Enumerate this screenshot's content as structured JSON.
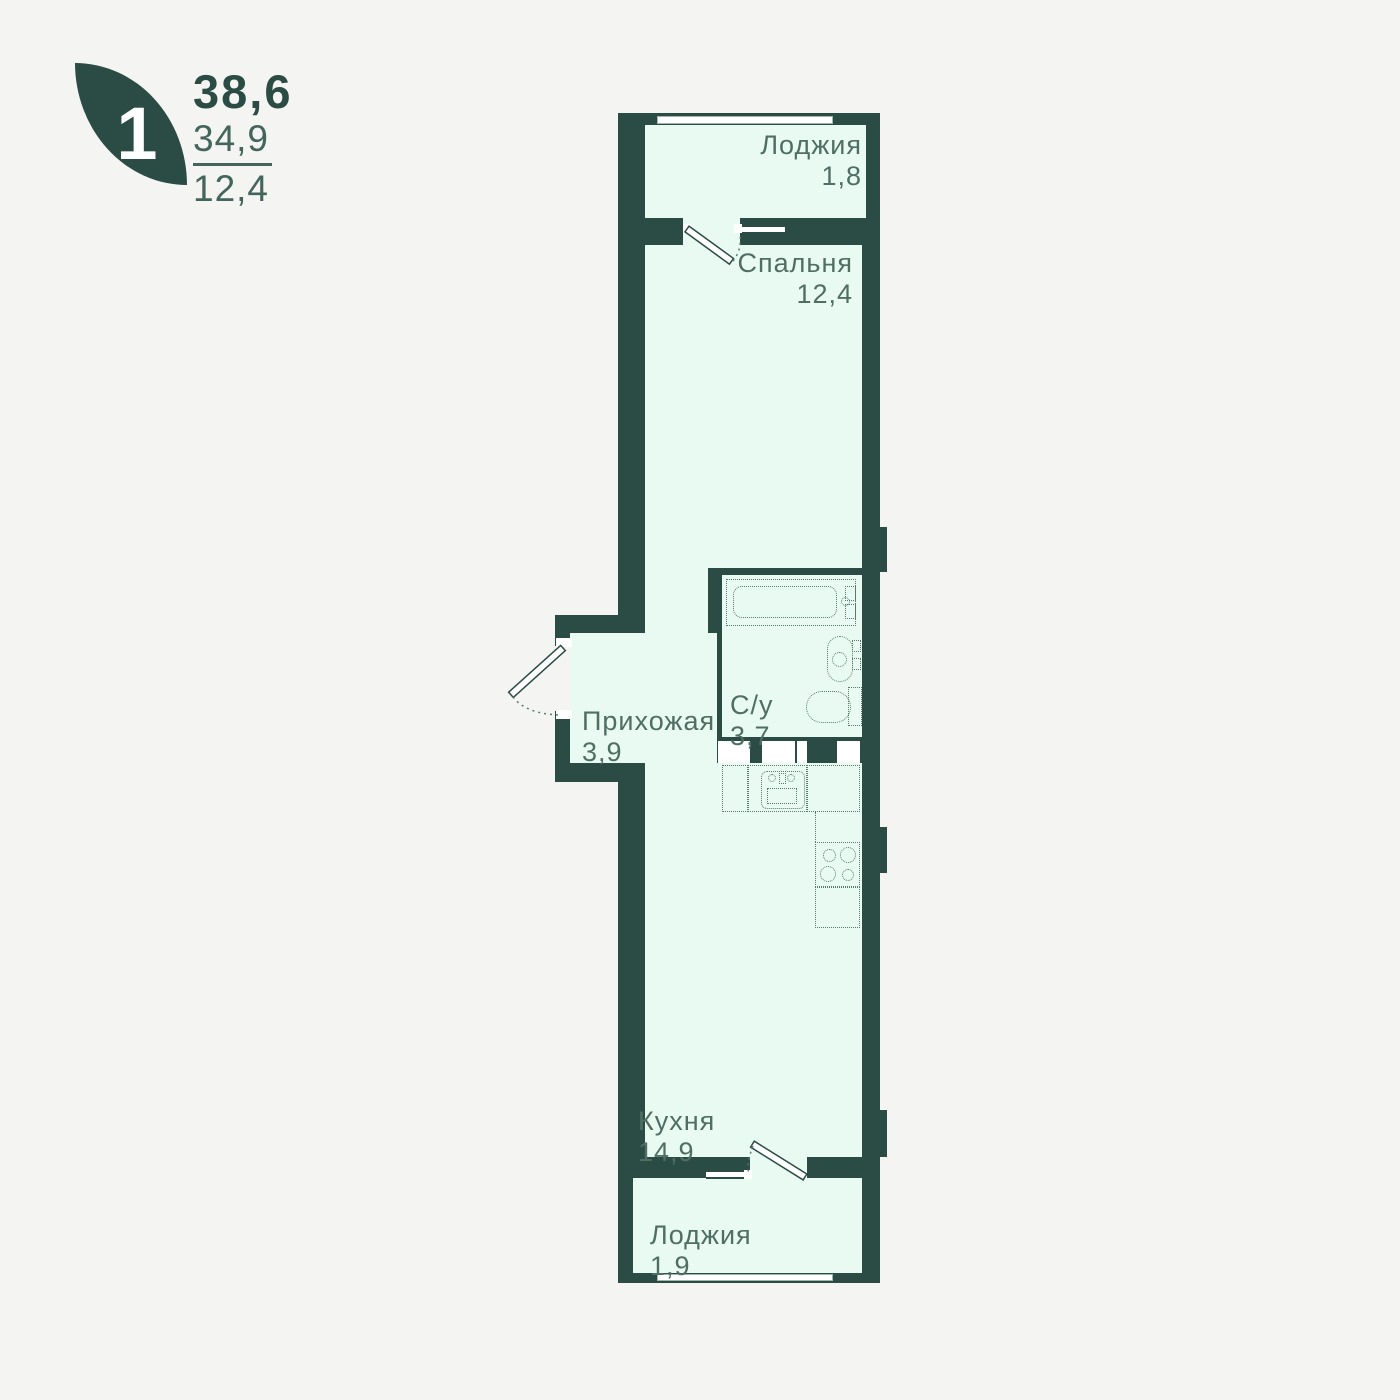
{
  "header": {
    "room_count": "1",
    "area_total": "38,6",
    "area_living": "34,9",
    "area_room": "12,4"
  },
  "rooms": {
    "loggia_top": {
      "name": "Лоджия",
      "area": "1,8"
    },
    "bedroom": {
      "name": "Спальня",
      "area": "12,4"
    },
    "hallway": {
      "name": "Прихожая",
      "area": "3,9"
    },
    "bathroom": {
      "name": "С/у",
      "area": "3,7"
    },
    "kitchen": {
      "name": "Кухня",
      "area": "14,9"
    },
    "loggia_bottom": {
      "name": "Лоджия",
      "area": "1,9"
    }
  },
  "colors": {
    "wall": "#2b4c44",
    "room_fill": "#e9faf2",
    "background": "#f4f4f2",
    "label": "#4f6f65",
    "window": "#ffffff"
  }
}
